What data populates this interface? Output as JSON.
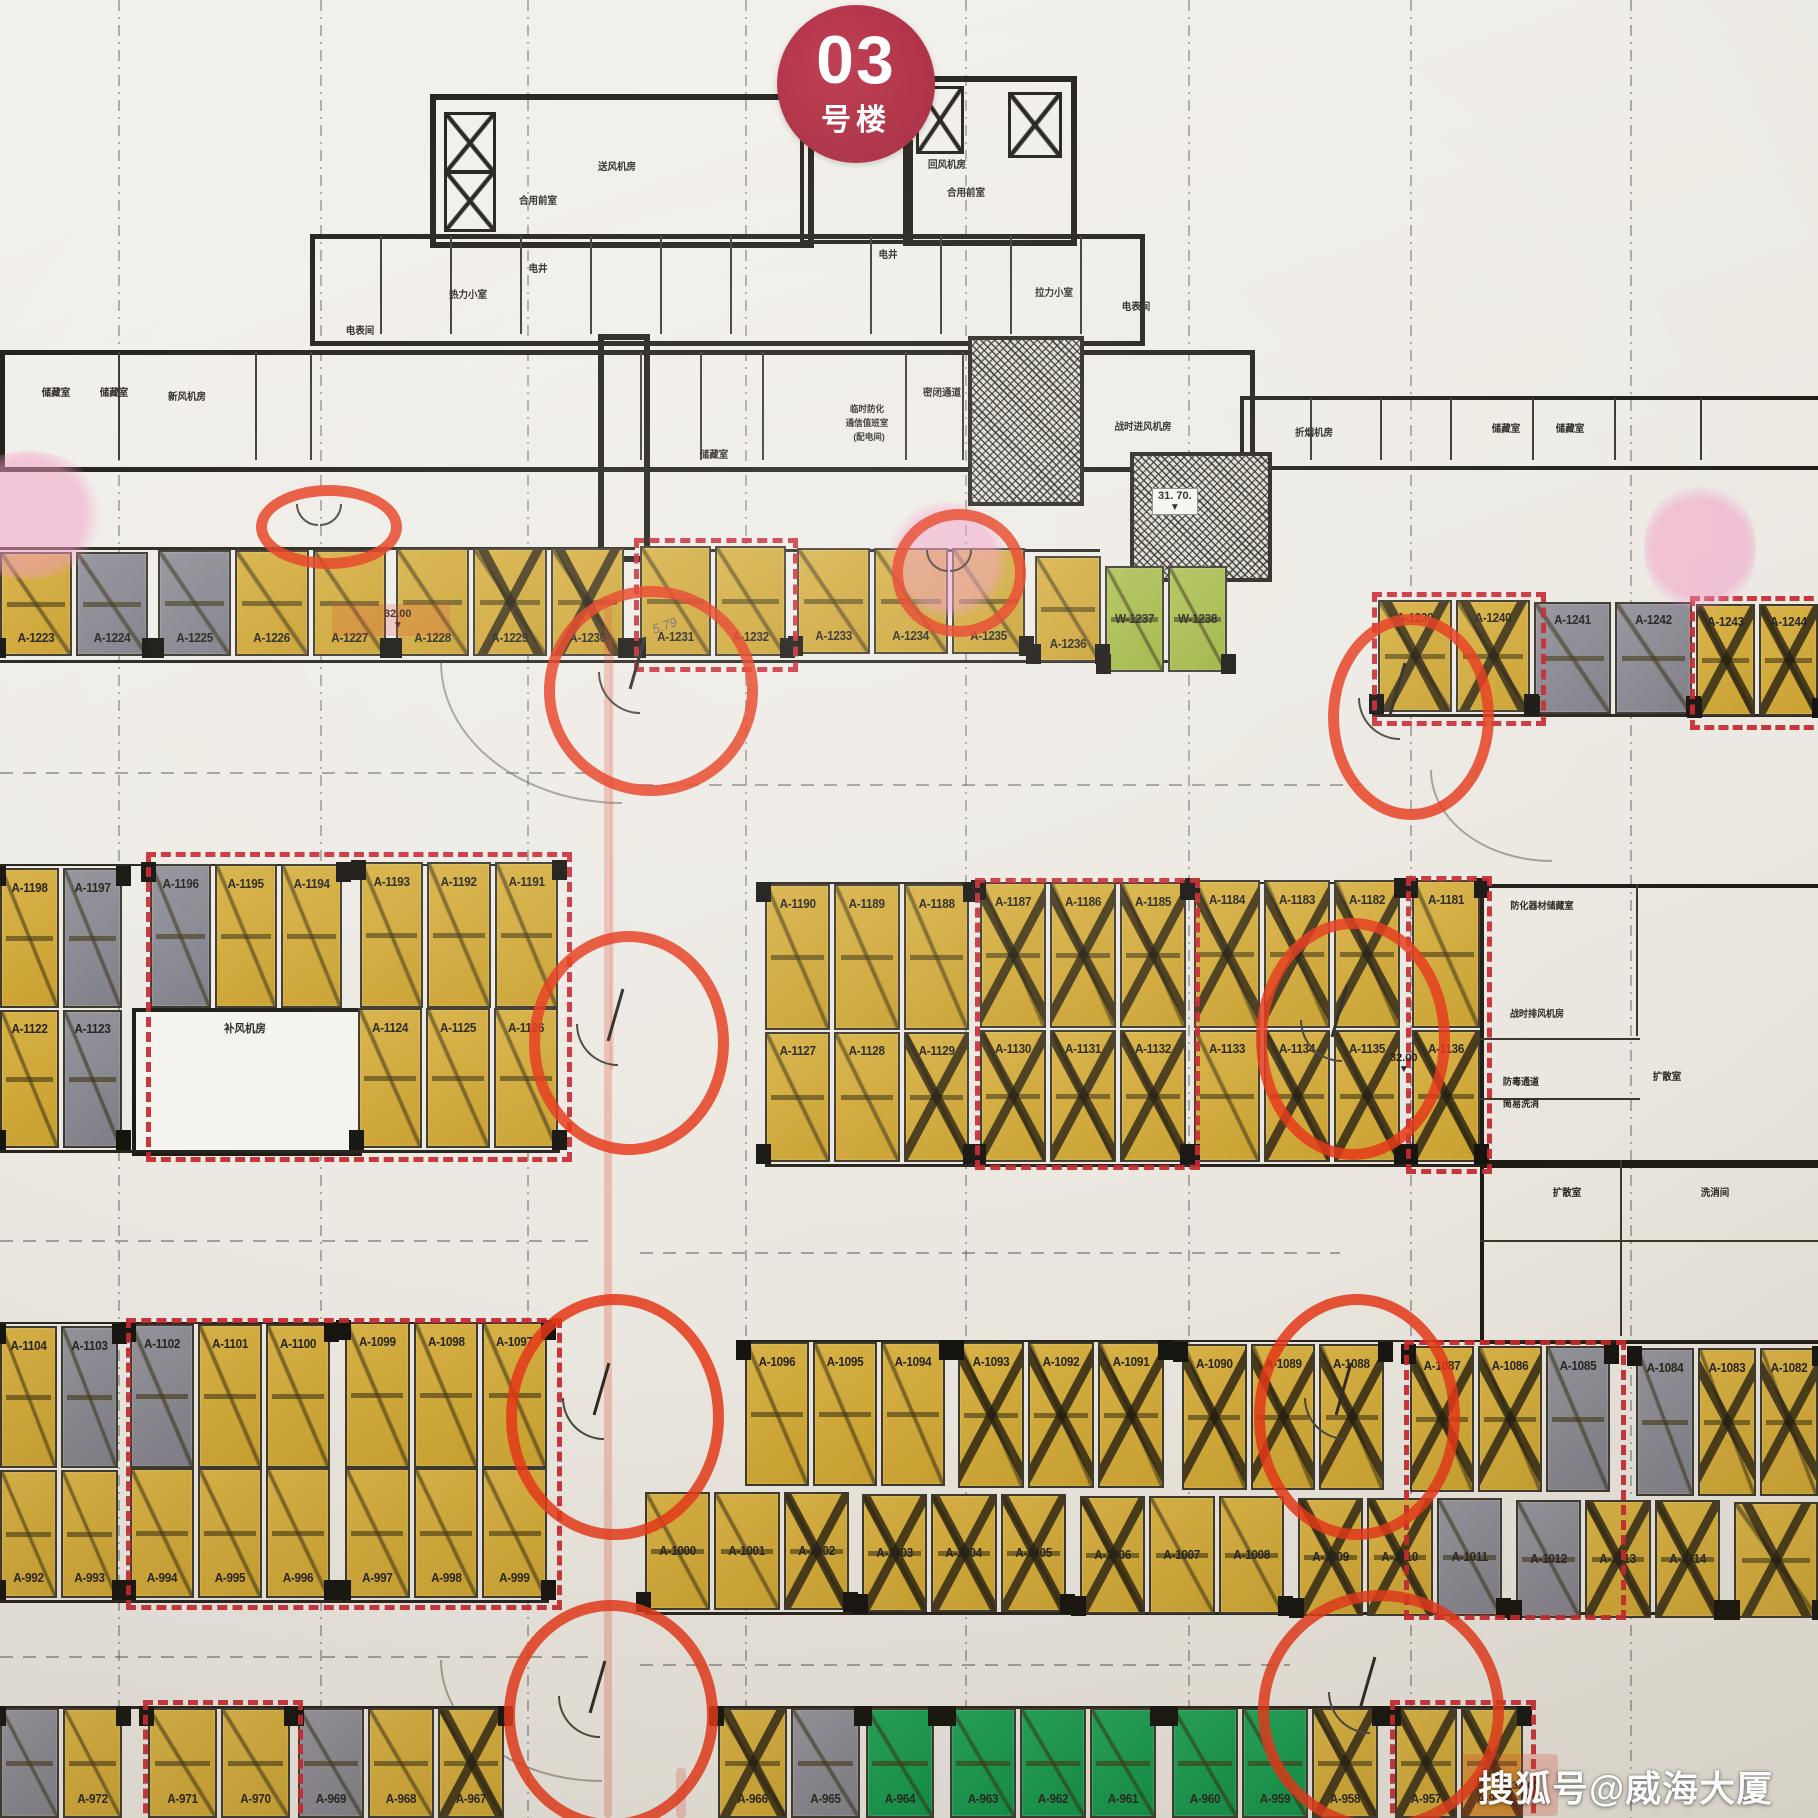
{
  "badge": {
    "number": "03",
    "suffix": "号楼"
  },
  "watermark": "搜狐号@威海大厦",
  "pencil_note": "5.79",
  "icons": {
    "triangle_down": "▼"
  },
  "colors": {
    "stall_yellow": "#d2ab3a",
    "stall_gray": "#8e8c94",
    "stall_green_light": "#a6bd4b",
    "stall_green": "#1b9a4f",
    "red_annotation": "#e53718",
    "red_dashed_outline": "#c6262e",
    "badge_red": "#a02136",
    "pink_highlight": "#f296c3"
  },
  "elevation_markers": [
    {
      "value": "32.00"
    },
    {
      "value": "31. 70."
    },
    {
      "value": "32.00"
    },
    {
      "value": "32.00"
    }
  ],
  "room_labels": [
    {
      "text": "储藏室"
    },
    {
      "text": "储藏室"
    },
    {
      "text": "新风机房"
    },
    {
      "text": "电表间"
    },
    {
      "text": "热力小室"
    },
    {
      "text": "电井"
    },
    {
      "text": "合用前室"
    },
    {
      "text": "送风机房"
    },
    {
      "text": "回风机房"
    },
    {
      "text": "合用前室"
    },
    {
      "text": "电井"
    },
    {
      "text": "拉力小室"
    },
    {
      "text": "电表间"
    },
    {
      "text": "储藏室"
    },
    {
      "text": "密闭通道"
    },
    {
      "text": "临时防化"
    },
    {
      "text": "通信值班室"
    },
    {
      "text": "(配电间)"
    },
    {
      "text": "战时进风机房"
    },
    {
      "text": "折烟机房"
    },
    {
      "text": "储藏室"
    },
    {
      "text": "储藏室"
    },
    {
      "text": "补风机房"
    },
    {
      "text": "防化器材储藏室"
    },
    {
      "text": "战时排风机房"
    },
    {
      "text": "防毒通道"
    },
    {
      "text": "简易洗消"
    },
    {
      "text": "扩散室"
    },
    {
      "text": "扩散室"
    },
    {
      "text": "洗消间"
    }
  ],
  "parking_blocks": [
    {
      "stalls": [
        {
          "label": "A-1223",
          "color": "yellow"
        },
        {
          "label": "A-1224",
          "color": "gray"
        }
      ]
    },
    {
      "stalls": [
        {
          "label": "A-1225",
          "color": "gray"
        },
        {
          "label": "A-1226",
          "color": "yellow"
        },
        {
          "label": "A-1227",
          "color": "yellow"
        }
      ]
    },
    {
      "stalls": [
        {
          "label": "A-1228",
          "color": "yellow"
        },
        {
          "label": "A-1229",
          "color": "yellow",
          "crossed": true
        },
        {
          "label": "A-1230",
          "color": "yellow",
          "crossed": true
        }
      ]
    },
    {
      "stalls": [
        {
          "label": "A-1231",
          "color": "yellow"
        },
        {
          "label": "A-1232",
          "color": "yellow"
        }
      ]
    },
    {
      "stalls": [
        {
          "label": "A-1233",
          "color": "yellow"
        },
        {
          "label": "A-1234",
          "color": "yellow"
        },
        {
          "label": "A-1235",
          "color": "yellow"
        }
      ]
    },
    {
      "stalls": [
        {
          "label": "A-1236",
          "color": "yellow"
        }
      ]
    },
    {
      "stalls": [
        {
          "label": "W-1237",
          "color": "green-light"
        },
        {
          "label": "W-1238",
          "color": "green-light"
        }
      ]
    },
    {
      "stalls": [
        {
          "label": "A-1239",
          "color": "yellow",
          "crossed": true
        },
        {
          "label": "A-1240",
          "color": "yellow",
          "crossed": true
        }
      ]
    },
    {
      "stalls": [
        {
          "label": "A-1241",
          "color": "gray"
        },
        {
          "label": "A-1242",
          "color": "gray"
        }
      ]
    },
    {
      "stalls": [
        {
          "label": "A-1243",
          "color": "yellow",
          "crossed": true
        },
        {
          "label": "A-1244",
          "color": "yellow",
          "crossed": true
        }
      ]
    },
    {
      "stalls": [
        {
          "label": "A-1198",
          "color": "yellow"
        },
        {
          "label": "A-1197",
          "color": "gray"
        }
      ]
    },
    {
      "stalls": [
        {
          "label": "A-1196",
          "color": "gray"
        },
        {
          "label": "A-1195",
          "color": "yellow"
        },
        {
          "label": "A-1194",
          "color": "yellow"
        }
      ]
    },
    {
      "stalls": [
        {
          "label": "A-1193",
          "color": "yellow"
        },
        {
          "label": "A-1192",
          "color": "yellow"
        },
        {
          "label": "A-1191",
          "color": "yellow"
        }
      ]
    },
    {
      "stalls": [
        {
          "label": "A-1190",
          "color": "yellow"
        },
        {
          "label": "A-1189",
          "color": "yellow"
        },
        {
          "label": "A-1188",
          "color": "yellow"
        }
      ]
    },
    {
      "stalls": [
        {
          "label": "A-1187",
          "color": "yellow",
          "crossed": true
        },
        {
          "label": "A-1186",
          "color": "yellow",
          "crossed": true
        },
        {
          "label": "A-1185",
          "color": "yellow",
          "crossed": true
        }
      ]
    },
    {
      "stalls": [
        {
          "label": "A-1184",
          "color": "yellow",
          "crossed": true
        },
        {
          "label": "A-1183",
          "color": "yellow",
          "crossed": true
        },
        {
          "label": "A-1182",
          "color": "yellow",
          "crossed": true
        }
      ]
    },
    {
      "stalls": [
        {
          "label": "A-1181",
          "color": "yellow"
        }
      ]
    },
    {
      "stalls": [
        {
          "label": "A-1122",
          "color": "yellow"
        },
        {
          "label": "A-1123",
          "color": "gray"
        }
      ]
    },
    {
      "stalls": [
        {
          "label": "A-1124",
          "color": "yellow"
        },
        {
          "label": "A-1125",
          "color": "yellow"
        },
        {
          "label": "A-1126",
          "color": "yellow"
        }
      ]
    },
    {
      "stalls": [
        {
          "label": "A-1127",
          "color": "yellow"
        },
        {
          "label": "A-1128",
          "color": "yellow"
        },
        {
          "label": "A-1129",
          "color": "yellow",
          "crossed": true
        }
      ]
    },
    {
      "stalls": [
        {
          "label": "A-1130",
          "color": "yellow",
          "crossed": true
        },
        {
          "label": "A-1131",
          "color": "yellow",
          "crossed": true
        },
        {
          "label": "A-1132",
          "color": "yellow",
          "crossed": true
        }
      ]
    },
    {
      "stalls": [
        {
          "label": "A-1133",
          "color": "yellow"
        },
        {
          "label": "A-1134",
          "color": "yellow",
          "crossed": true
        },
        {
          "label": "A-1135",
          "color": "yellow",
          "crossed": true
        }
      ]
    },
    {
      "stalls": [
        {
          "label": "A-1136",
          "color": "yellow",
          "crossed": true
        }
      ]
    },
    {
      "stalls": [
        {
          "label": "A-1104",
          "color": "yellow"
        },
        {
          "label": "A-1103",
          "color": "gray"
        }
      ]
    },
    {
      "stalls": [
        {
          "label": "A-1102",
          "color": "gray"
        },
        {
          "label": "A-1101",
          "color": "yellow"
        },
        {
          "label": "A-1100",
          "color": "yellow"
        }
      ]
    },
    {
      "stalls": [
        {
          "label": "A-1099",
          "color": "yellow"
        },
        {
          "label": "A-1098",
          "color": "yellow"
        },
        {
          "label": "A-1097",
          "color": "yellow"
        }
      ]
    },
    {
      "stalls": [
        {
          "label": "A-1096",
          "color": "yellow"
        },
        {
          "label": "A-1095",
          "color": "yellow"
        },
        {
          "label": "A-1094",
          "color": "yellow"
        }
      ]
    },
    {
      "stalls": [
        {
          "label": "A-1093",
          "color": "yellow",
          "crossed": true
        },
        {
          "label": "A-1092",
          "color": "yellow",
          "crossed": true
        },
        {
          "label": "A-1091",
          "color": "yellow",
          "crossed": true
        }
      ]
    },
    {
      "stalls": [
        {
          "label": "A-1090",
          "color": "yellow",
          "crossed": true
        },
        {
          "label": "A-1089",
          "color": "yellow",
          "crossed": true
        },
        {
          "label": "A-1088",
          "color": "yellow",
          "crossed": true
        }
      ]
    },
    {
      "stalls": [
        {
          "label": "A-1087",
          "color": "yellow",
          "crossed": true
        },
        {
          "label": "A-1086",
          "color": "yellow",
          "crossed": true
        },
        {
          "label": "A-1085",
          "color": "gray"
        }
      ]
    },
    {
      "stalls": [
        {
          "label": "A-1084",
          "color": "gray"
        },
        {
          "label": "A-1083",
          "color": "yellow",
          "crossed": true
        },
        {
          "label": "A-1082",
          "color": "yellow",
          "crossed": true
        }
      ]
    },
    {
      "stalls": [
        {
          "label": "A-992",
          "color": "yellow"
        },
        {
          "label": "A-993",
          "color": "yellow"
        }
      ]
    },
    {
      "stalls": [
        {
          "label": "A-994",
          "color": "yellow"
        },
        {
          "label": "A-995",
          "color": "yellow"
        },
        {
          "label": "A-996",
          "color": "yellow"
        }
      ]
    },
    {
      "stalls": [
        {
          "label": "A-997",
          "color": "yellow"
        },
        {
          "label": "A-998",
          "color": "yellow"
        },
        {
          "label": "A-999",
          "color": "yellow"
        }
      ]
    },
    {
      "stalls": [
        {
          "label": "A-1000",
          "color": "yellow"
        },
        {
          "label": "A-1001",
          "color": "yellow"
        },
        {
          "label": "A-1002",
          "color": "yellow",
          "crossed": true
        }
      ]
    },
    {
      "stalls": [
        {
          "label": "A-1003",
          "color": "yellow",
          "crossed": true
        },
        {
          "label": "A-1004",
          "color": "yellow",
          "crossed": true
        },
        {
          "label": "A-1005",
          "color": "yellow",
          "crossed": true
        }
      ]
    },
    {
      "stalls": [
        {
          "label": "A-1006",
          "color": "yellow",
          "crossed": true
        },
        {
          "label": "A-1007",
          "color": "yellow"
        },
        {
          "label": "A-1008",
          "color": "yellow"
        }
      ]
    },
    {
      "stalls": [
        {
          "label": "A-1009",
          "color": "yellow",
          "crossed": true
        },
        {
          "label": "A-1010",
          "color": "yellow",
          "crossed": true
        },
        {
          "label": "A-1011",
          "color": "gray"
        }
      ]
    },
    {
      "stalls": [
        {
          "label": "A-1012",
          "color": "gray"
        },
        {
          "label": "A-1013",
          "color": "yellow",
          "crossed": true
        },
        {
          "label": "A-1014",
          "color": "yellow",
          "crossed": true
        }
      ]
    },
    {
      "stalls": [
        {
          "label": "",
          "color": "yellow",
          "crossed": true
        }
      ]
    },
    {
      "stalls": [
        {
          "label": "",
          "color": "gray"
        },
        {
          "label": "A-972",
          "color": "yellow"
        }
      ]
    },
    {
      "stalls": [
        {
          "label": "A-971",
          "color": "yellow"
        },
        {
          "label": "A-970",
          "color": "yellow"
        }
      ]
    },
    {
      "stalls": [
        {
          "label": "A-969",
          "color": "gray"
        },
        {
          "label": "A-968",
          "color": "yellow"
        },
        {
          "label": "A-967",
          "color": "yellow",
          "crossed": true
        }
      ]
    },
    {
      "stalls": [
        {
          "label": "A-966",
          "color": "yellow",
          "crossed": true
        },
        {
          "label": "A-965",
          "color": "gray"
        }
      ]
    },
    {
      "stalls": [
        {
          "label": "A-964",
          "color": "green"
        }
      ]
    },
    {
      "stalls": [
        {
          "label": "A-963",
          "color": "green"
        },
        {
          "label": "A-962",
          "color": "green"
        },
        {
          "label": "A-961",
          "color": "green"
        }
      ]
    },
    {
      "stalls": [
        {
          "label": "A-960",
          "color": "green"
        },
        {
          "label": "A-959",
          "color": "green"
        },
        {
          "label": "A-958",
          "color": "yellow",
          "crossed": true
        }
      ]
    },
    {
      "stalls": [
        {
          "label": "A-957",
          "color": "yellow",
          "crossed": true
        },
        {
          "label": "A-956",
          "color": "yellow",
          "crossed": true
        }
      ]
    }
  ]
}
